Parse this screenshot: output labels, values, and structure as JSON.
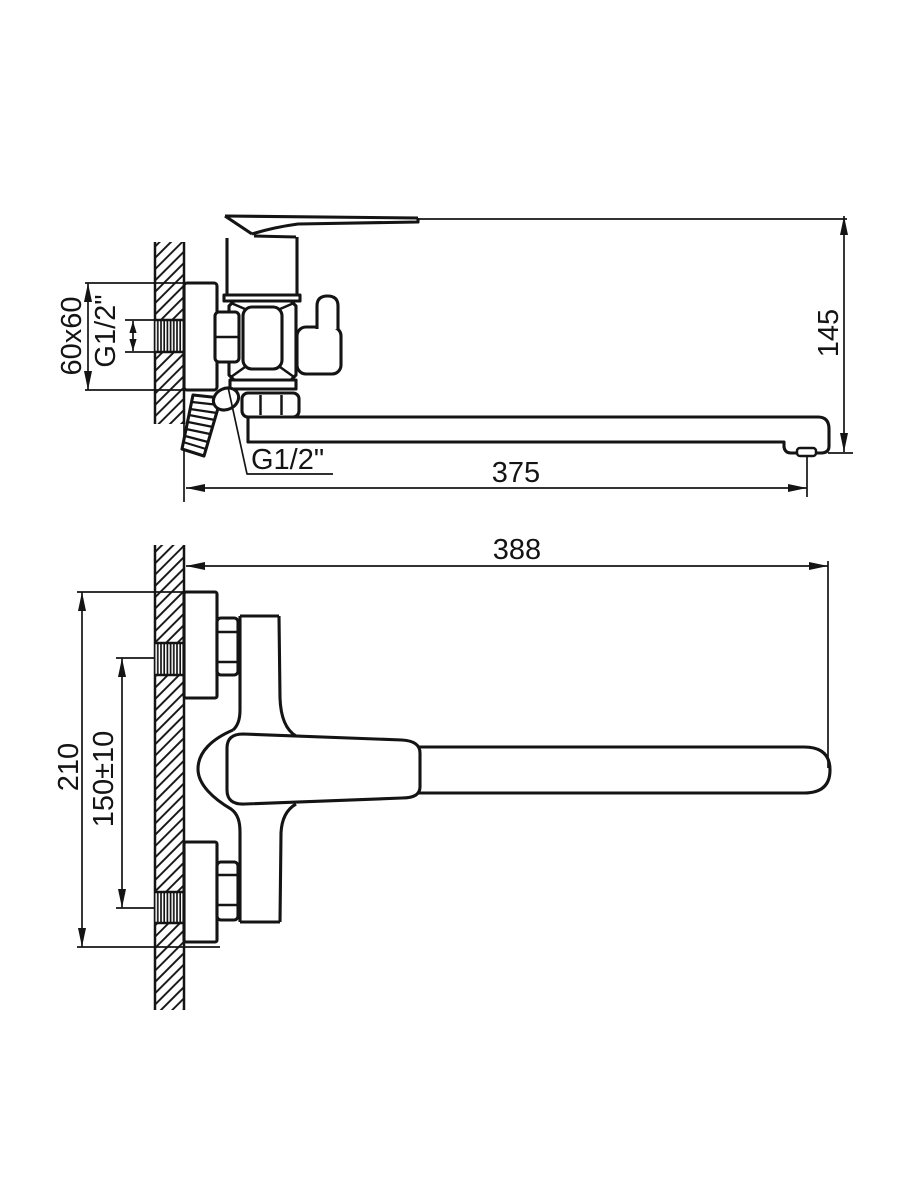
{
  "diagram": {
    "kind": "technical-dimension-drawing",
    "views": {
      "side": {
        "labels": {
          "plate_size": "60x60",
          "wall_thread": "G1/2\"",
          "shower_thread": "G1/2\"",
          "height": "145",
          "spout_reach": "375"
        }
      },
      "plan": {
        "labels": {
          "overall_length": "388",
          "overall_height": "210",
          "hole_centers": "150±10"
        }
      }
    },
    "colors": {
      "ink": "#141414",
      "background": "#ffffff"
    }
  }
}
